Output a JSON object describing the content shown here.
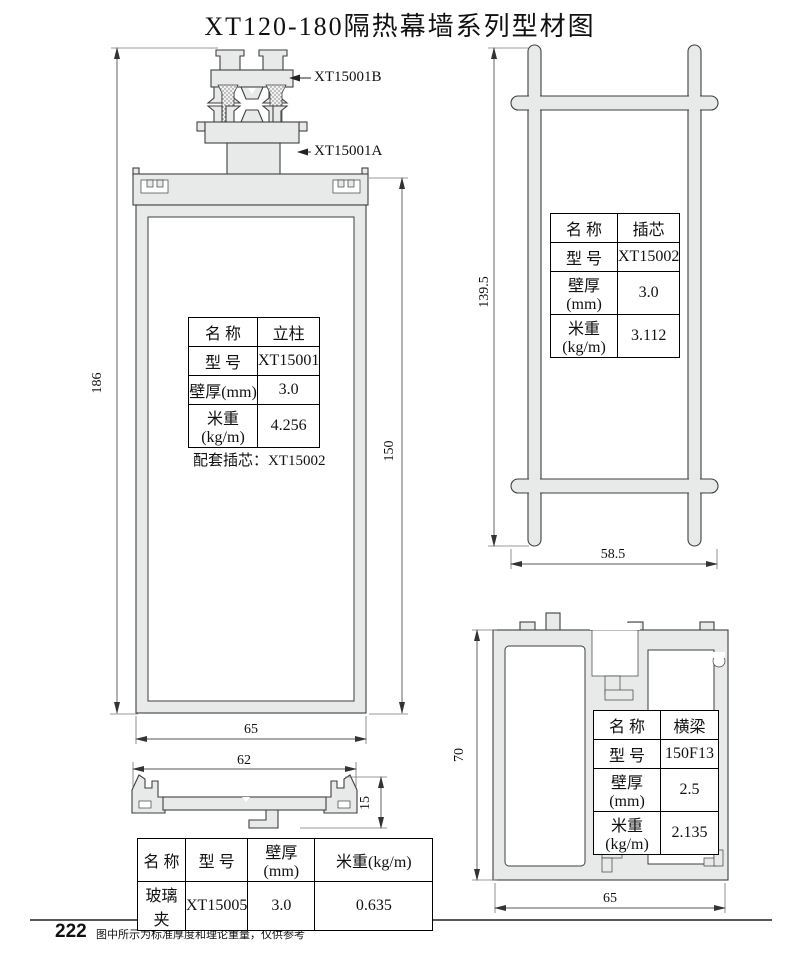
{
  "page": {
    "title": "XT120-180隔热幕墙系列型材图",
    "page_number": "222",
    "footer_note": "图中所示为标准厚度和理论重量，仅供参考"
  },
  "colors": {
    "profile_fill": "#e8eae9",
    "outline": "#3f3f3f",
    "dim_line": "#555555",
    "text": "#111111"
  },
  "mullion": {
    "callout_top": "XT15001B",
    "callout_bottom": "XT15001A",
    "dim_total_height": "186",
    "dim_body_height": "150",
    "dim_width": "65",
    "table": {
      "rows": [
        {
          "label": "名 称",
          "value": "立柱"
        },
        {
          "label": "型 号",
          "value": "XT15001"
        },
        {
          "label": "壁厚(mm)",
          "value": "3.0"
        },
        {
          "label": "米重(kg/m)",
          "value": "4.256"
        }
      ]
    },
    "note": "配套插芯：XT15002"
  },
  "insert_core": {
    "dim_height": "139.5",
    "dim_width": "58.5",
    "table": {
      "rows": [
        {
          "label": "名 称",
          "value": "插芯"
        },
        {
          "label": "型 号",
          "value": "XT15002"
        },
        {
          "label": "壁厚(mm)",
          "value": "3.0"
        },
        {
          "label": "米重(kg/m)",
          "value": "3.112"
        }
      ]
    }
  },
  "glass_clamp": {
    "dim_width": "62",
    "dim_height": "15",
    "table": {
      "headers": [
        "名 称",
        "型 号",
        "壁厚(mm)",
        "米重(kg/m)"
      ],
      "row": [
        "玻璃夹",
        "XT15005",
        "3.0",
        "0.635"
      ]
    }
  },
  "beam": {
    "dim_height": "70",
    "dim_width": "65",
    "table": {
      "rows": [
        {
          "label": "名 称",
          "value": "横梁"
        },
        {
          "label": "型 号",
          "value": "150F13"
        },
        {
          "label": "壁厚(mm)",
          "value": "2.5"
        },
        {
          "label": "米重(kg/m)",
          "value": "2.135"
        }
      ]
    },
    "note": "配套盖板：XT15003G"
  }
}
